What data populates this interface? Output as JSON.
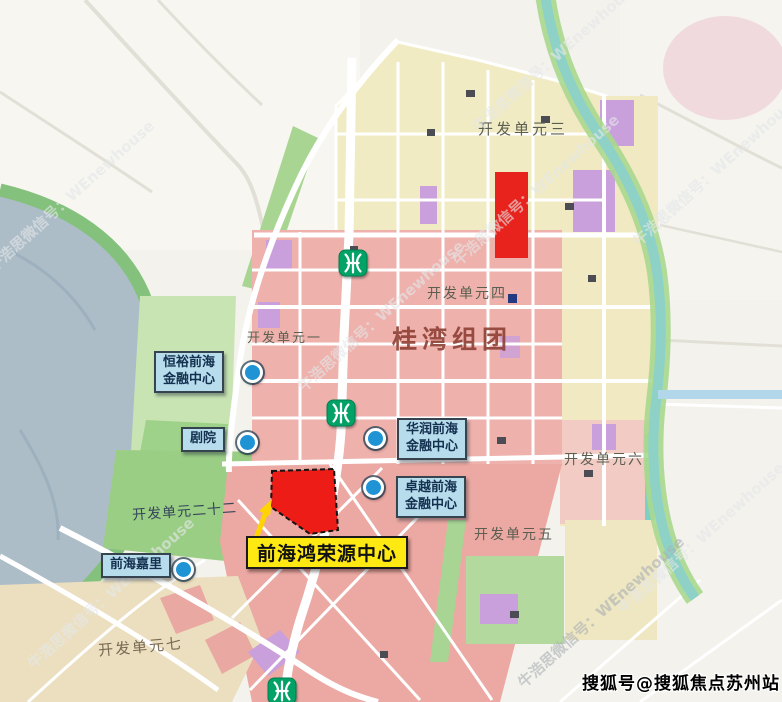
{
  "watermark": {
    "diagonal": "牛浩思微信号：WEnewhouse",
    "sohu": "搜狐号@搜狐焦点苏州站"
  },
  "map": {
    "district_title": "桂湾组团",
    "units": {
      "u1": "开发单元一",
      "u3": "开发单元三",
      "u4": "开发单元四",
      "u5": "开发单元五",
      "u6": "开发单元六",
      "u7": "开发单元七",
      "u22": "开发单元二十二"
    },
    "callouts": {
      "hengyu": {
        "line1": "恒裕前海",
        "line2": "金融中心"
      },
      "theater": {
        "line1": "剧院"
      },
      "huarun": {
        "line1": "华润前海",
        "line2": "金融中心"
      },
      "zhuoyue": {
        "line1": "卓越前海",
        "line2": "金融中心"
      },
      "kerry": {
        "line1": "前海嘉里"
      }
    },
    "highlight": {
      "label": "前海鸿荣源中心",
      "site_color": "#ed1c16",
      "label_bg": "#ffe913"
    },
    "icons": {
      "metro": "shenzhen-metro-logo",
      "marker": "blue-dot-marker"
    },
    "colors": {
      "water": "#adbdc8",
      "park_green": "#a8d494",
      "residential_pink": "#eeb1ac",
      "commercial_cream": "#f1ebc3",
      "public_purple": "#c9a0dc",
      "highlight_red": "#e8231d",
      "callout_bg": "#b7dcec",
      "metro_green": "#00a266"
    }
  }
}
